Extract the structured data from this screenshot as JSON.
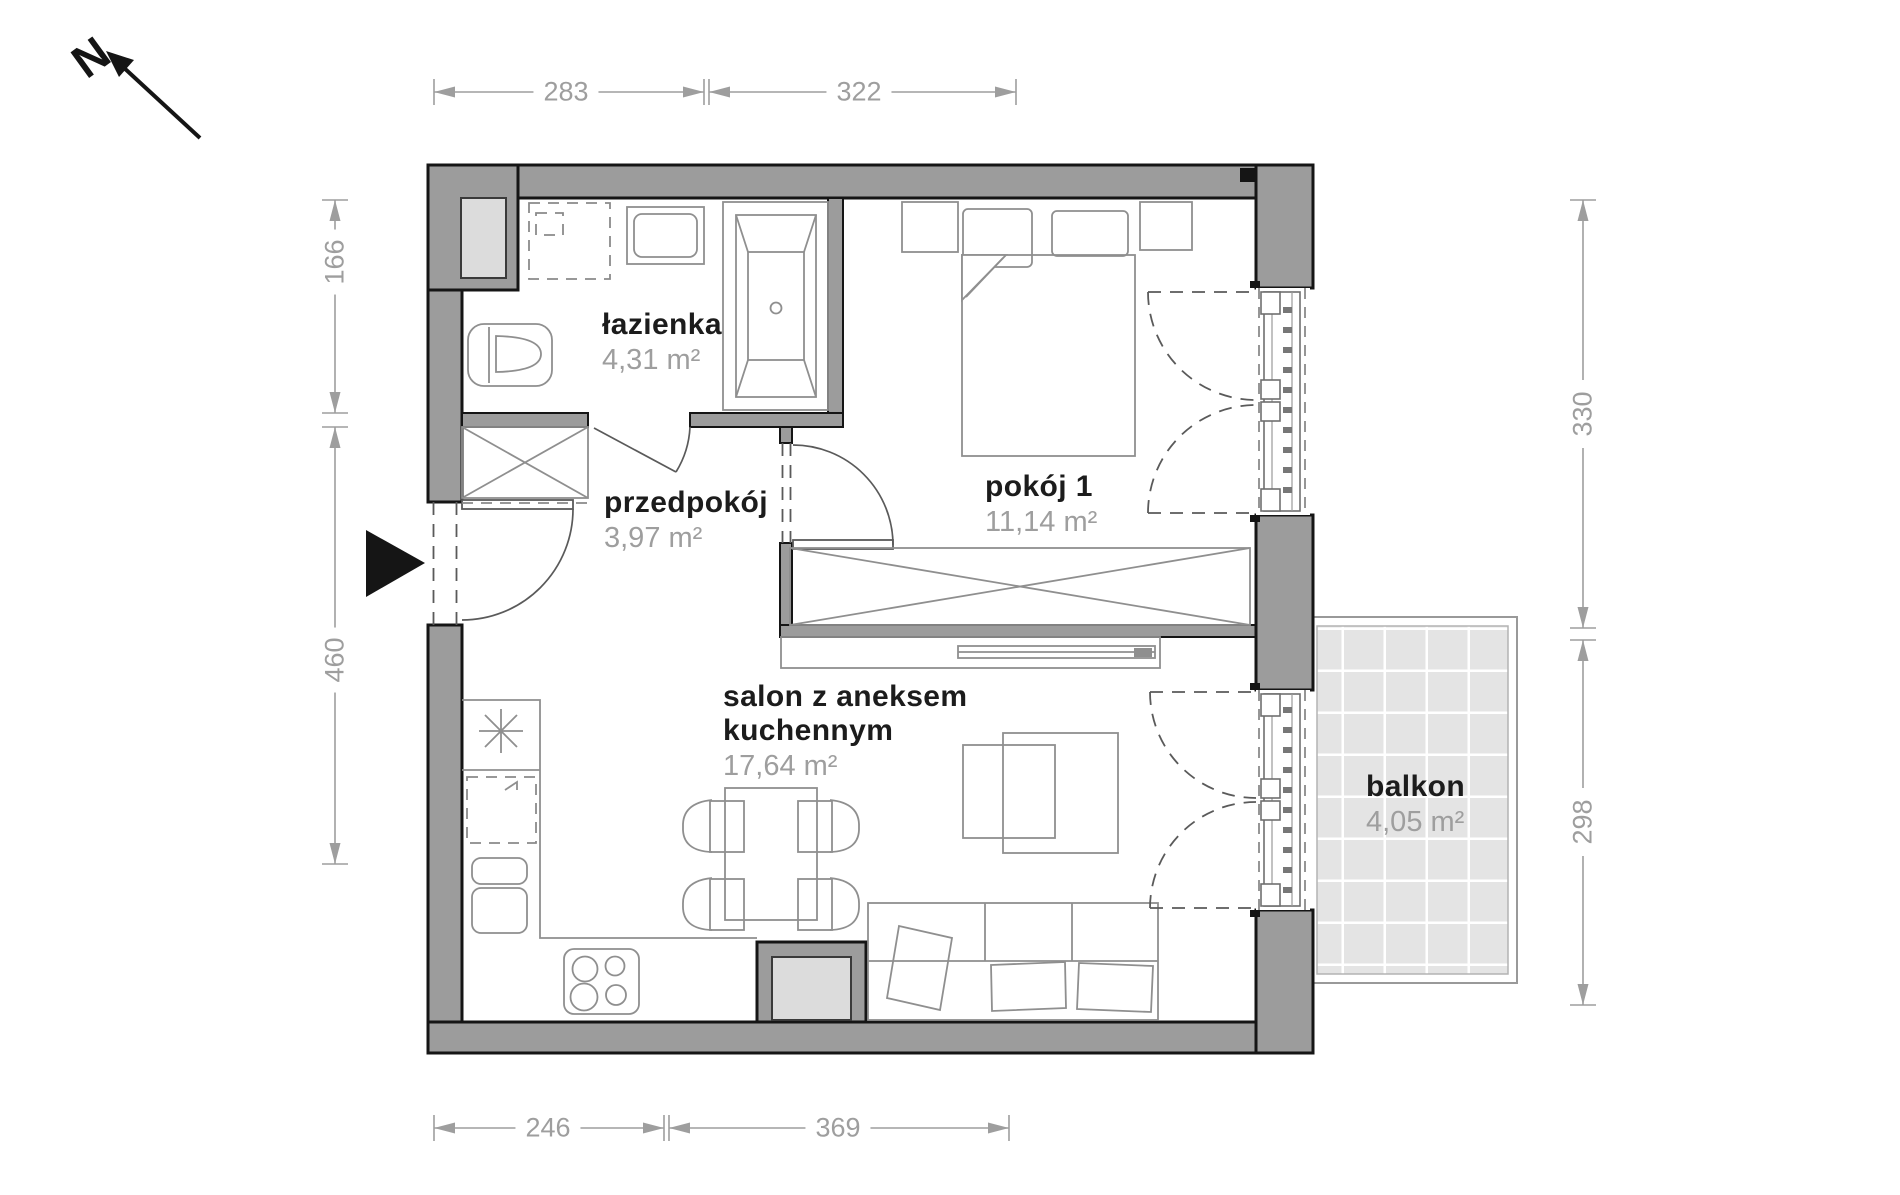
{
  "north": {
    "label": "N"
  },
  "rooms": {
    "lazienka": {
      "name": "łazienka",
      "area": "4,31 m²"
    },
    "przedpokoj": {
      "name": "przedpokój",
      "area": "3,97 m²"
    },
    "pokoj1": {
      "name": "pokój 1",
      "area": "11,14 m²"
    },
    "salon": {
      "name_line1": "salon z aneksem",
      "name_line2": "kuchennym",
      "area": "17,64 m²"
    },
    "balkon": {
      "name": "balkon",
      "area": "4,05 m²"
    }
  },
  "dimensions": {
    "top": [
      "283",
      "322"
    ],
    "bottom": [
      "246",
      "369"
    ],
    "left": [
      "166",
      "460"
    ],
    "right": [
      "330",
      "298"
    ]
  },
  "colors": {
    "wall": "#9c9c9c",
    "ink": "#151515",
    "furniture": "#8f8f8f",
    "dim": "#9e9e9e",
    "room-name": "#1c1c1c",
    "room-area": "#9e9e9e",
    "shaft": "#dcdcdc",
    "tile": "#e4e4e4"
  }
}
